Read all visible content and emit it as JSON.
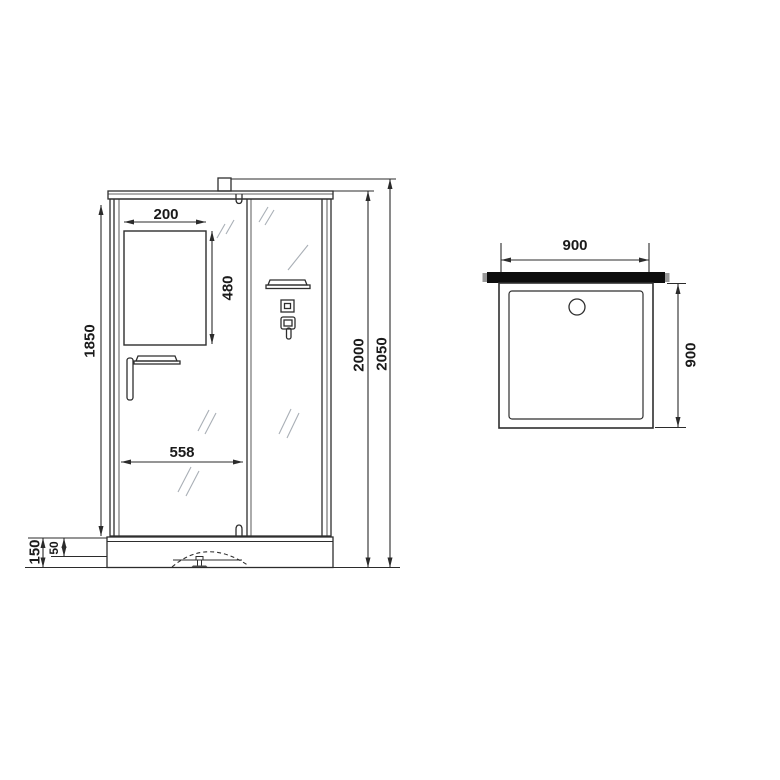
{
  "drawing": {
    "type": "shower-cabin-technical-drawing",
    "views": {
      "front": "front elevation",
      "top": "tray plan view"
    }
  },
  "front_view": {
    "dims": {
      "mirror_width": "200",
      "mirror_height": "480",
      "body_height": "1850",
      "door_width": "558",
      "base_height": "150",
      "base_step": "50",
      "cabin_height": "2000",
      "total_height": "2050"
    }
  },
  "top_view": {
    "dims": {
      "width": "900",
      "depth": "900"
    }
  },
  "colors": {
    "line": "#2e2e2e",
    "dimension_line": "#2b2b2b",
    "glass_hatch": "#a9afb6",
    "wall_profile": "#0d0d0d",
    "background": "#ffffff"
  }
}
